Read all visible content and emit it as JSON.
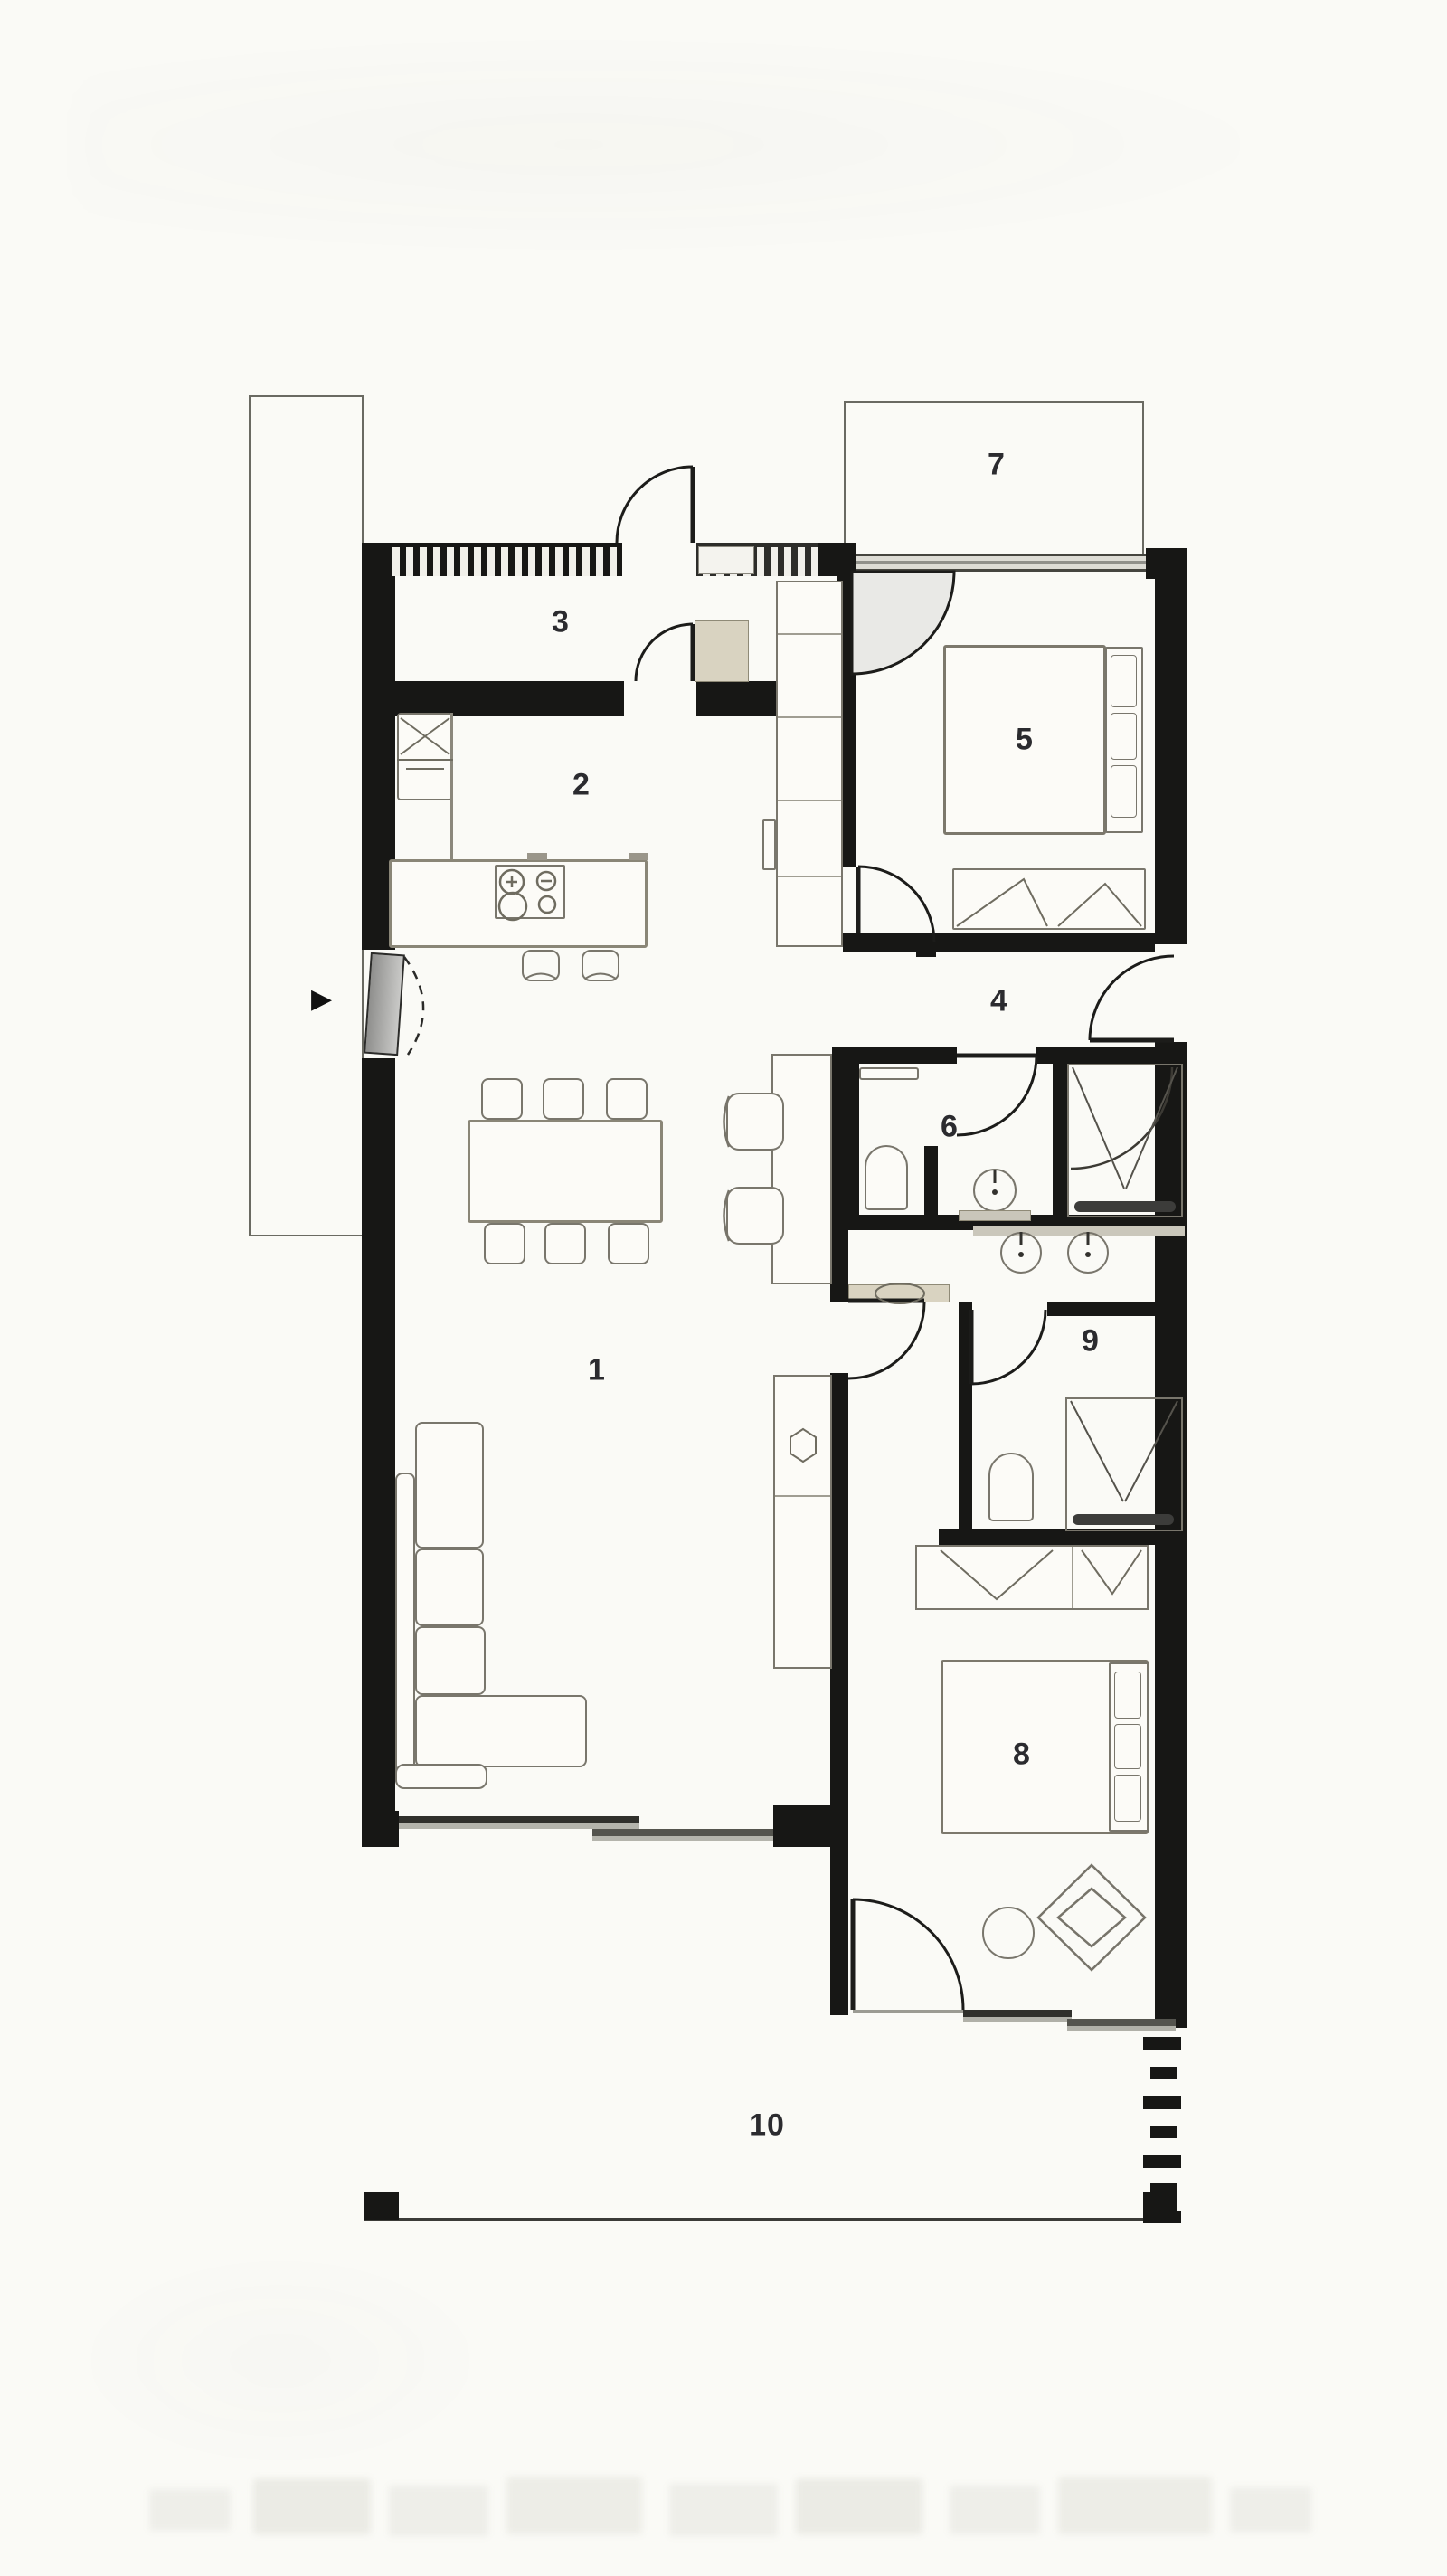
{
  "plan": {
    "rooms": [
      {
        "key": "living-dining",
        "label": "1"
      },
      {
        "key": "kitchen",
        "label": "2"
      },
      {
        "key": "entry-hall",
        "label": "3"
      },
      {
        "key": "hallway",
        "label": "4"
      },
      {
        "key": "bedroom-top",
        "label": "5"
      },
      {
        "key": "bathroom",
        "label": "6"
      },
      {
        "key": "balcony",
        "label": "7"
      },
      {
        "key": "bedroom-bottom",
        "label": "8"
      },
      {
        "key": "ensuite-wc",
        "label": "9"
      },
      {
        "key": "terrace",
        "label": "10"
      }
    ],
    "entry_arrow_glyph": "▶",
    "colors": {
      "wall": "#171715",
      "glass_dark": "#45453f",
      "glass_light": "#dddcd5",
      "tan_accent": "#d9d3c1",
      "label_text": "#2b2b2f",
      "paper": "#fafaf6"
    }
  }
}
